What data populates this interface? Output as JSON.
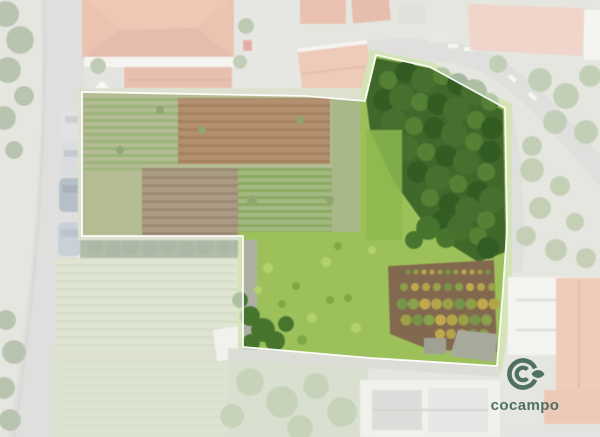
{
  "watermark": {
    "brand": "cocampo",
    "brand_color": "#3a6150",
    "icon": "concentric-c-rings-with-leaf"
  },
  "parcel_overlay": {
    "boundary_points": "82,92 305,96 365,101 376,55 430,67 505,108 507,230 503,290 497,366 370,358 243,347 243,236 82,236",
    "boundary_color": "#ffffff",
    "boundary_width": 1.8,
    "wash_color": "#ffffff",
    "wash_opacity": 0.56
  },
  "scene_palette": {
    "road": "#b7b9b3",
    "roof_terracotta": "#d1764f",
    "farmland": "#b4bc93",
    "forest_green": "#40682b",
    "meadow_green": "#9dc15a",
    "bare_soil": "#82684f"
  }
}
